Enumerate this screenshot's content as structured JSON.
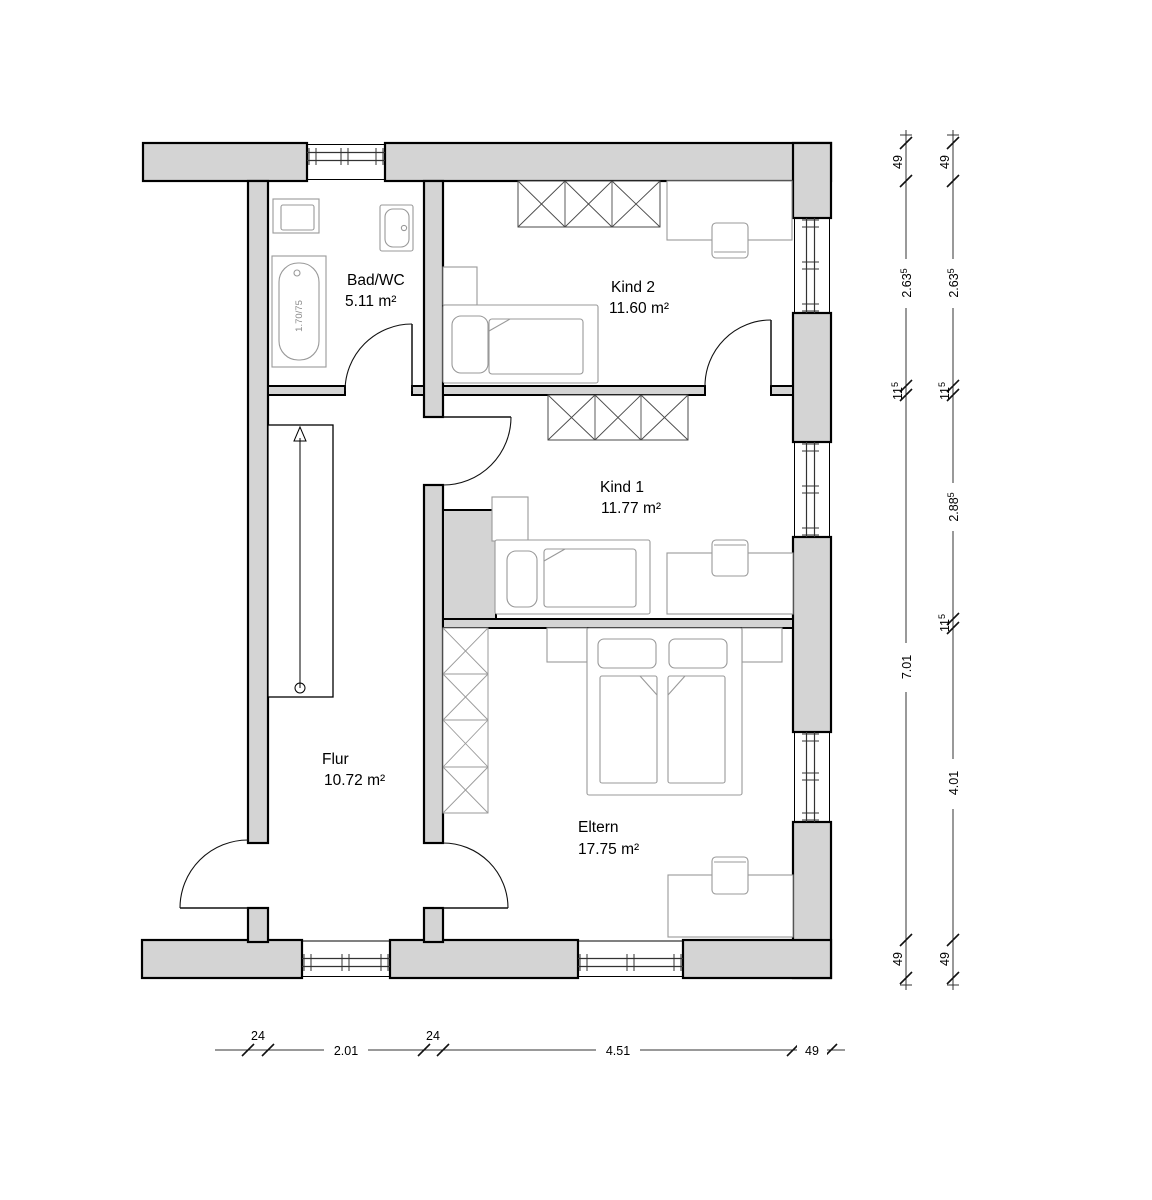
{
  "plan": {
    "rooms": [
      {
        "id": "bad-wc",
        "name": "Bad/WC",
        "area": "5.11 m²"
      },
      {
        "id": "kind-2",
        "name": "Kind 2",
        "area": "11.60 m²"
      },
      {
        "id": "kind-1",
        "name": "Kind 1",
        "area": "11.77 m²"
      },
      {
        "id": "flur",
        "name": "Flur",
        "area": "10.72 m²"
      },
      {
        "id": "eltern",
        "name": "Eltern",
        "area": "17.75 m²"
      }
    ],
    "fixtures": {
      "bathtub_size_label": "1.70/75"
    }
  },
  "dimensions": {
    "bottom_chain": [
      "24",
      "2.01",
      "24",
      "4.51",
      "49"
    ],
    "right_inner_chain": [
      {
        "v": "49",
        "sup": ""
      },
      {
        "v": "2.63",
        "sup": "5"
      },
      {
        "v": "11",
        "sup": "5"
      },
      {
        "v": "7.01",
        "sup": ""
      },
      {
        "v": "49",
        "sup": ""
      }
    ],
    "right_outer_chain": [
      {
        "v": "49",
        "sup": ""
      },
      {
        "v": "2.63",
        "sup": "5"
      },
      {
        "v": "11",
        "sup": "5"
      },
      {
        "v": "2.88",
        "sup": "5"
      },
      {
        "v": "11",
        "sup": "5"
      },
      {
        "v": "4.01",
        "sup": ""
      },
      {
        "v": "49",
        "sup": ""
      }
    ]
  },
  "colors": {
    "wall_fill": "#d4d4d4",
    "outline": "#000000",
    "furniture": "#999999",
    "background": "#ffffff"
  }
}
